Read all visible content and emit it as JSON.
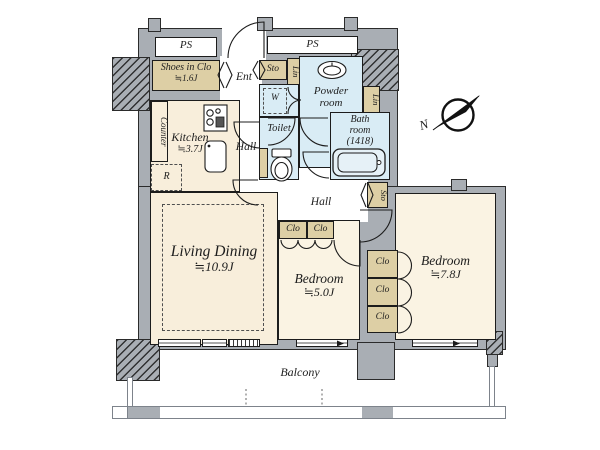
{
  "floorplan": {
    "service": {
      "pipe_space": "PS"
    },
    "entry": {
      "entrance": "Ent",
      "shoes_closet": "Shoes in Clo",
      "shoes_closet_size": "≒1.6J"
    },
    "rooms": {
      "living_dining": {
        "name": "Living Dining",
        "size": "≒10.9J"
      },
      "bedroom_center": {
        "name": "Bedroom",
        "size": "≒5.0J"
      },
      "bedroom_right": {
        "name": "Bedroom",
        "size": "≒7.8J"
      },
      "kitchen": {
        "name": "Kitchen",
        "size": "≒3.7J"
      },
      "powder_room": {
        "line1": "Powder",
        "line2": "room"
      },
      "bath_room": {
        "line1": "Bath",
        "line2": "room",
        "line3": "(1418)"
      },
      "toilet": "Toilet",
      "hall_upper": "Hall",
      "hall_lower": "Hall",
      "balcony": "Balcony"
    },
    "storage": {
      "sto": "Sto",
      "lin": "Lin",
      "clo": "Clo",
      "counter": "Counter",
      "washer": "W",
      "refrigerator": "R"
    },
    "compass": {
      "north": "N"
    },
    "colors": {
      "wall_gray": "#a9aeb4",
      "room_cream": "#f8eedb",
      "bedroom_cream": "#faf3e3",
      "water_blue": "#d9ecf5",
      "closet_tan": "#ddcfa5",
      "outline": "#1c1c1c"
    }
  }
}
